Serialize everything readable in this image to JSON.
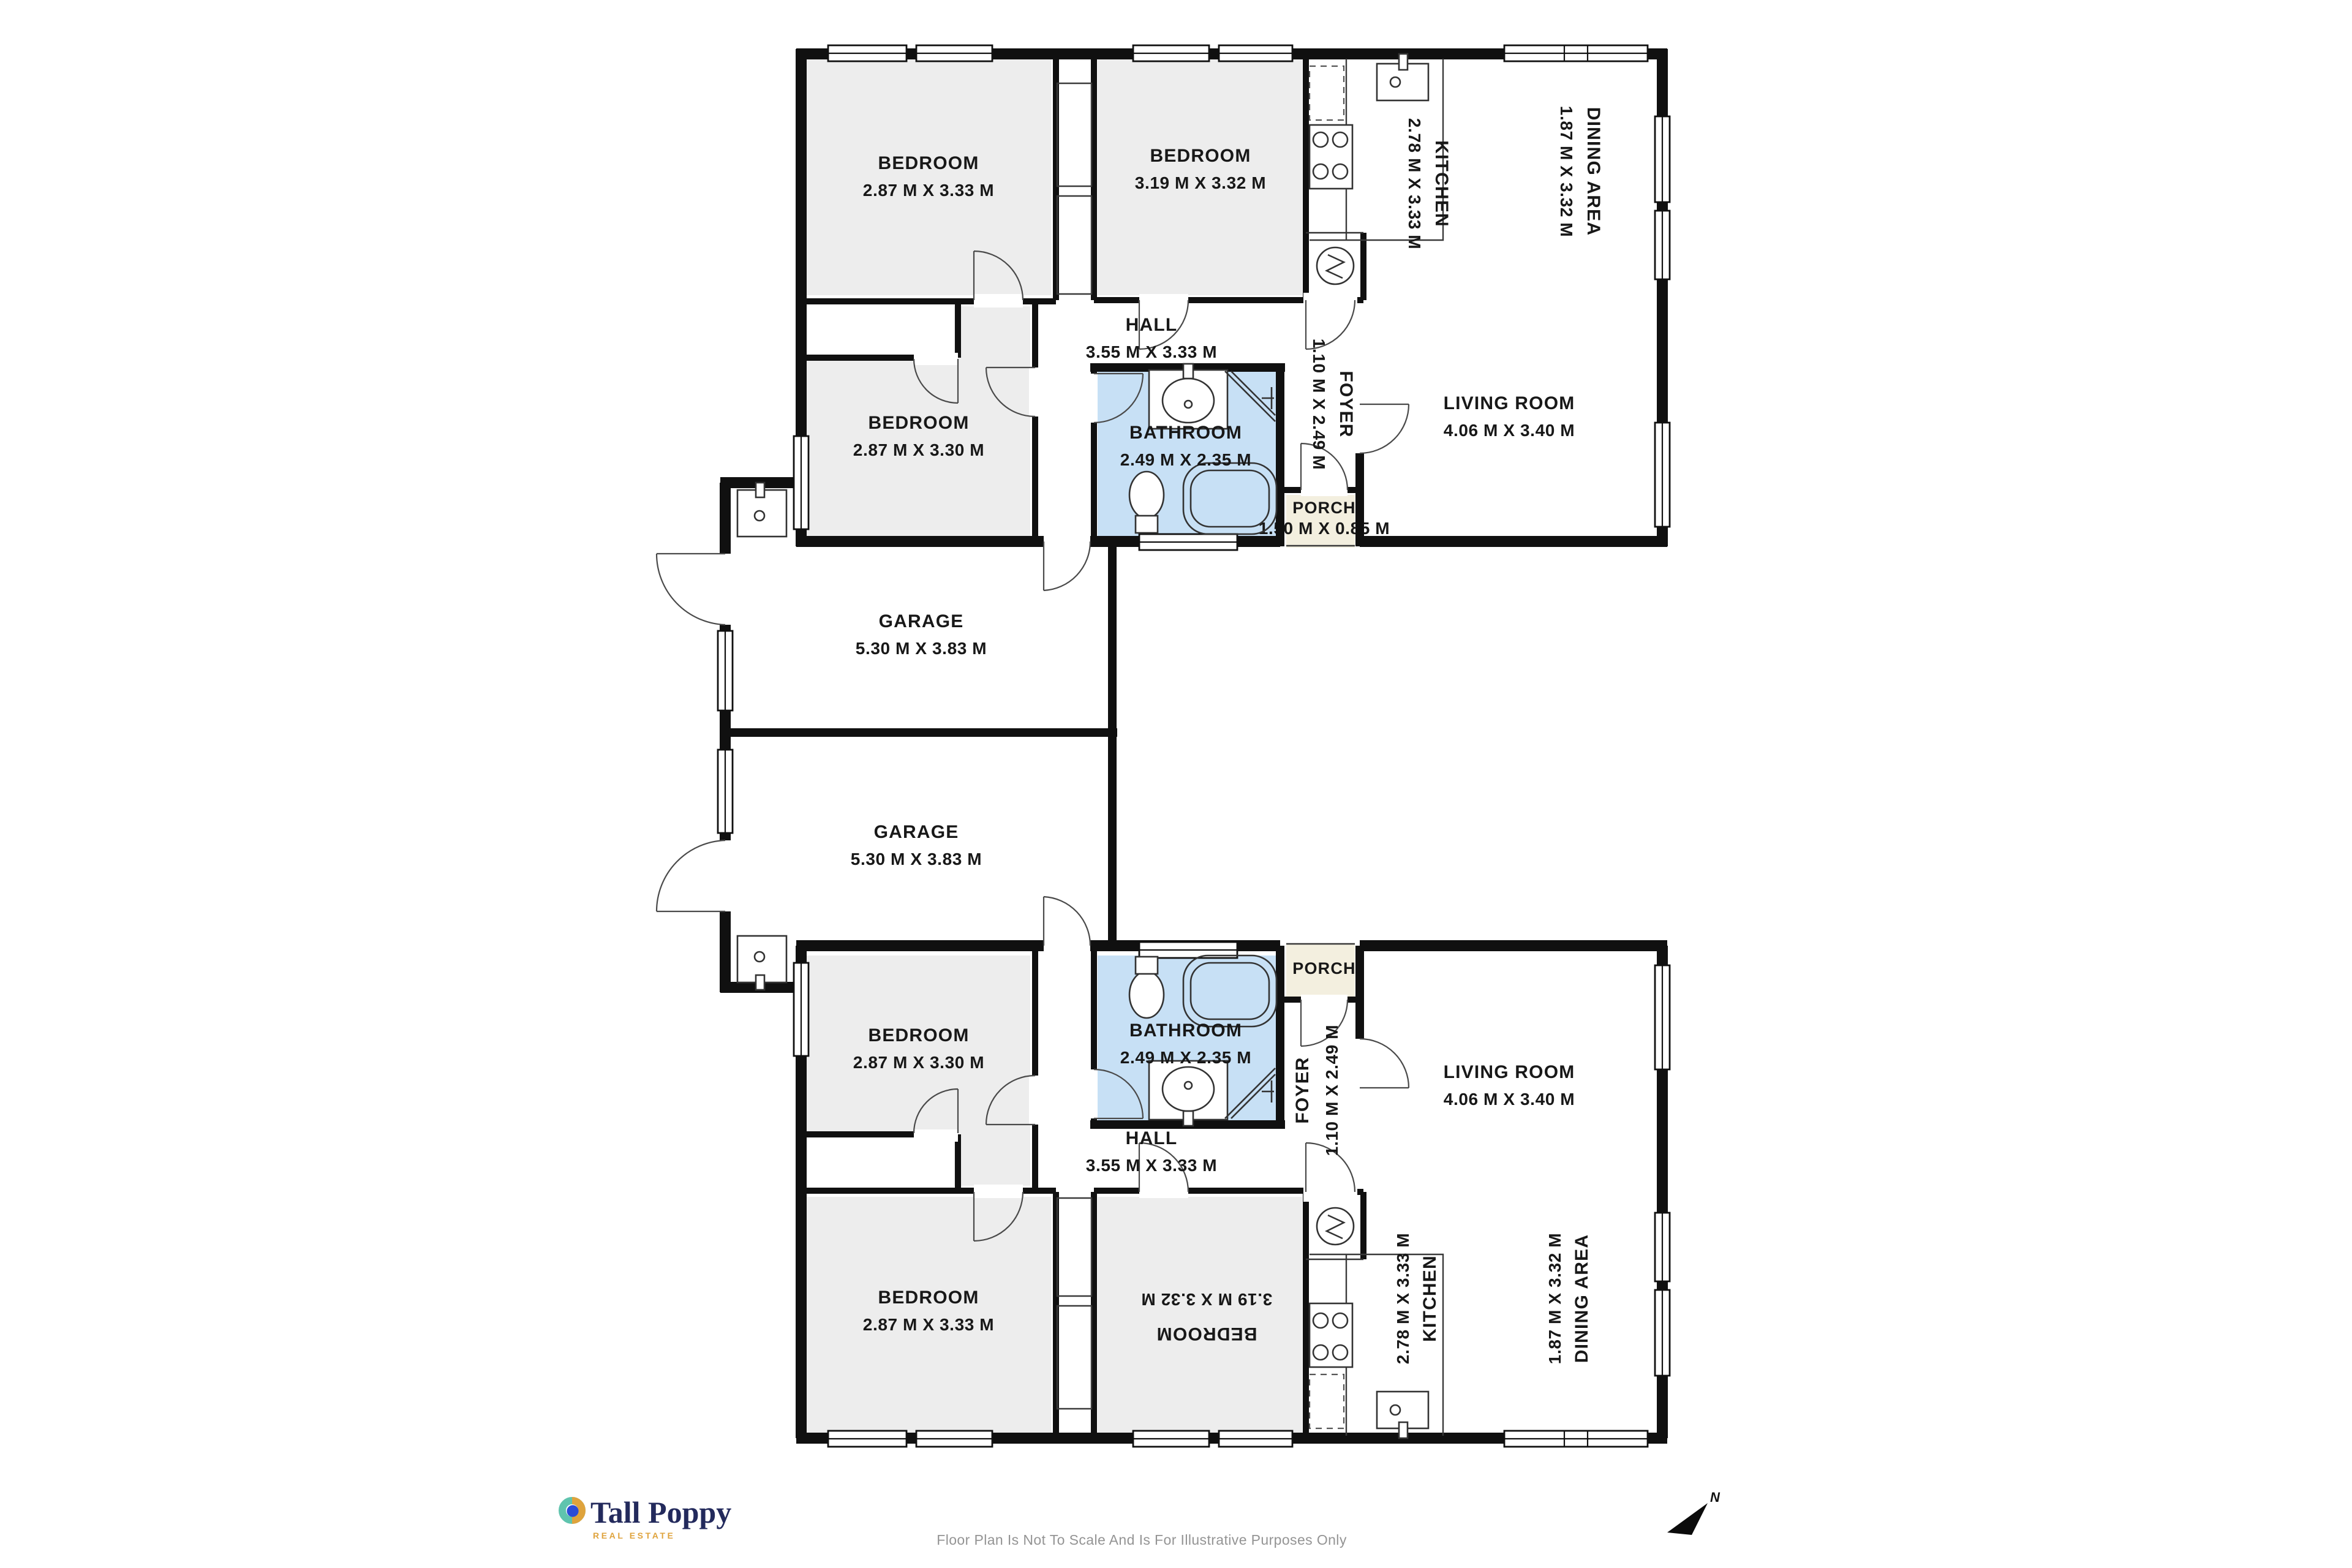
{
  "rooms": {
    "upper": {
      "bedroom_a": {
        "name": "BEDROOM",
        "dims": "2.87 M X 3.33 M"
      },
      "bedroom_b": {
        "name": "BEDROOM",
        "dims": "3.19 M X 3.32 M"
      },
      "bedroom_c": {
        "name": "BEDROOM",
        "dims": "2.87 M X 3.30 M"
      },
      "hall": {
        "name": "HALL",
        "dims": "3.55 M X 3.33 M"
      },
      "kitchen": {
        "name": "KITCHEN",
        "dims": "2.78 M X 3.33 M"
      },
      "dining": {
        "name": "DINING AREA",
        "dims": "1.87 M X 3.32 M"
      },
      "living": {
        "name": "LIVING ROOM",
        "dims": "4.06 M X 3.40 M"
      },
      "bathroom": {
        "name": "BATHROOM",
        "dims": "2.49 M X 2.35 M"
      },
      "foyer": {
        "name": "FOYER",
        "dims": "1.10 M X 2.49 M"
      },
      "porch": {
        "name": "PORCH",
        "dims": "1.50 M X 0.85 M"
      },
      "garage": {
        "name": "GARAGE",
        "dims": "5.30 M X 3.83 M"
      }
    },
    "lower": {
      "bedroom_d": {
        "name": "BEDROOM",
        "dims": "2.87 M X 3.30 M"
      },
      "bedroom_e": {
        "name": "BEDROOM",
        "dims": "2.87 M X 3.33 M"
      },
      "bedroom_f": {
        "name": "BEDROOM",
        "dims": "3.19 M X 3.32 M"
      },
      "hall": {
        "name": "HALL",
        "dims": "3.55 M X 3.33 M"
      },
      "kitchen": {
        "name": "KITCHEN",
        "dims": "2.78 M X 3.33 M"
      },
      "dining": {
        "name": "DINING AREA",
        "dims": "1.87 M X 3.32 M"
      },
      "living": {
        "name": "LIVING ROOM",
        "dims": "4.06 M X 3.40 M"
      },
      "bathroom": {
        "name": "BATHROOM",
        "dims": "2.49 M X 2.35 M"
      },
      "foyer": {
        "name": "FOYER",
        "dims": "1.10 M X 2.49 M"
      },
      "porch": {
        "name": "PORCH"
      },
      "garage": {
        "name": "GARAGE",
        "dims": "5.30 M X 3.83 M"
      }
    }
  },
  "branding": {
    "name": "Tall Poppy",
    "tagline": "REAL ESTATE",
    "colors": {
      "navy": "#232a5c",
      "gold": "#dfa33c",
      "teal": "#5fc4ae",
      "blue": "#2b4bd7"
    }
  },
  "footer": {
    "disclaimer": "Floor Plan Is Not To Scale And Is For Illustrative Purposes Only",
    "compass": {
      "label": "N"
    }
  },
  "palette": {
    "wall": "#101010",
    "bedroom_fill": "#ededed",
    "bathroom_fill": "#c7e0f5",
    "porch_fill": "#f3efdf",
    "disclaimer_text": "#949494"
  }
}
